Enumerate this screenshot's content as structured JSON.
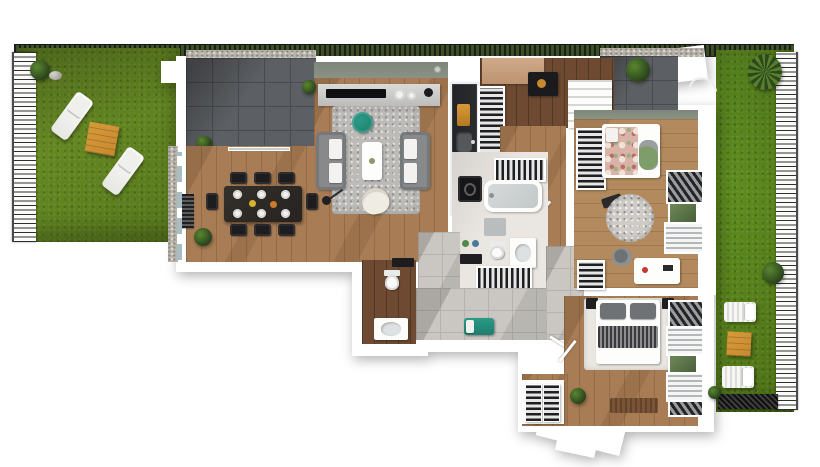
{
  "scene": {
    "type": "3d-apartment-floor-plan-render",
    "view": "top-down",
    "background": "#ffffff"
  },
  "colors": {
    "grass_left": "#6e9226",
    "grass_right": "#679c23",
    "hedge": "#3f512a",
    "paver": "#5c5f63",
    "paver_line": "#484b4f",
    "gravel": "#b7b3ab",
    "wall": "#ffffff",
    "wood": "#a87c54",
    "wood_light": "#b38a5e",
    "wood_dark": "#6d4a31",
    "tile": "#cac7c2",
    "tile_line": "#b6b3ad",
    "rug": "#bdbbb8",
    "sofa_gray": "#87898b",
    "teal": "#1f7e6e",
    "orange": "#c8892f",
    "kitchen_counter": "#2a2c2e",
    "sage_wall": "#8a9285",
    "bath_floor": "#eae6e1",
    "duvet_floral": "#d9b2a8",
    "doormat_brown": "#7b5437",
    "bed_pillow_gray": "#6f7275"
  },
  "exterior": {
    "left_garden": {
      "type": "lawn",
      "objects": [
        "picket-fence",
        "hedge-line",
        "bush",
        "stone",
        "sun-lounger",
        "wooden-side-table",
        "sun-lounger"
      ]
    },
    "main_terrace": {
      "type": "paved-terrace",
      "objects": [
        "gravel-border",
        "planter-wall",
        "shrub"
      ]
    },
    "right_terrace": {
      "type": "paved-terrace",
      "objects": [
        "planter-wall",
        "shrub",
        "soil-patch-with-hose",
        "palm-plant"
      ]
    },
    "right_garden": {
      "type": "lawn",
      "objects": [
        "picket-fence",
        "sun-lounger",
        "wooden-side-table",
        "sun-lounger",
        "dark-grate",
        "bush"
      ]
    }
  },
  "rooms": {
    "living_room": {
      "floor": "wood",
      "furniture": [
        "media-sideboard",
        "flat-tv",
        "decor-plates",
        "area-rug",
        "sofa",
        "sofa",
        "white-coffee-table",
        "teal-pouf",
        "cream-armchair",
        "floor-lamp",
        "wall-vent"
      ]
    },
    "dining_area": {
      "floor": "wood",
      "furniture": [
        "black-dining-table",
        "eight-dining-chairs",
        "place-settings",
        "radiator",
        "potted-plant",
        "glass-wall"
      ]
    },
    "kitchen": {
      "floor": "wood",
      "furniture": [
        "dark-countertop",
        "sink",
        "four-burner-hob",
        "orange-canister",
        "tall-storage-rack"
      ]
    },
    "pantry": {
      "floor": "dark-wood",
      "furniture": [
        "wood-counter",
        "black-appliance",
        "white-shelving"
      ]
    },
    "bathroom": {
      "floor": "stone",
      "furniture": [
        "towel-shelf",
        "washing-machine",
        "bathtub",
        "bath-mat",
        "toilet",
        "vanity-sink",
        "dark-counter",
        "storage-shelf"
      ]
    },
    "wc": {
      "floor": "dark-wood",
      "furniture": [
        "dark-shelf",
        "toilet",
        "vanity-sink"
      ]
    },
    "hallway": {
      "floor": "gray-tile",
      "furniture": [
        "teal-bench",
        "interior-doors"
      ]
    },
    "kids_bedroom": {
      "floor": "wood",
      "furniture": [
        "wardrobe",
        "single-bed-floral",
        "beanbag-chair",
        "toy",
        "round-rug",
        "storage-shelf",
        "desk",
        "desk-chair",
        "window-shutters"
      ]
    },
    "master_bedroom": {
      "floor": "wood",
      "furniture": [
        "double-bed",
        "gray-pillows",
        "striped-throw",
        "nightstand",
        "nightstand",
        "bedside-rug",
        "open-wardrobe",
        "potted-plant",
        "doormat",
        "window-shutters"
      ]
    }
  }
}
